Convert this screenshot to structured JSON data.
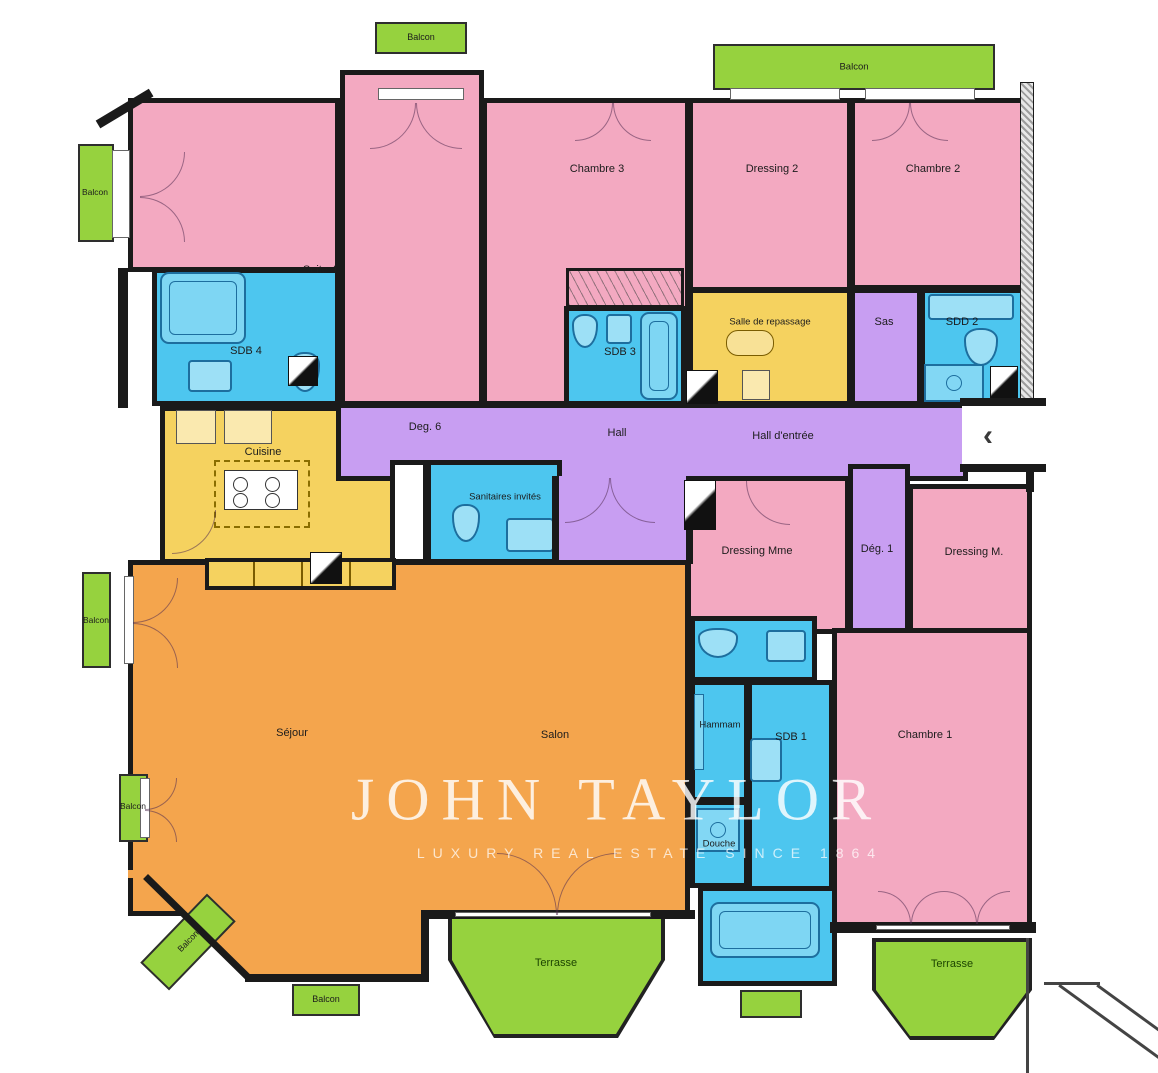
{
  "watermark": {
    "line1": "JOHN TAYLOR",
    "line2": "LUXURY REAL ESTATE SINCE 1864"
  },
  "palette": {
    "pink": "#F3A9C1",
    "blue": "#4DC6EF",
    "yellow": "#F5D25F",
    "purple": "#C89EF2",
    "orange": "#F4A54D",
    "green": "#96D23E",
    "wall": "#1A1A1A"
  },
  "labels": {
    "suite4": "Suite 4",
    "sdb4": "SDB 4",
    "chambre3": "Chambre 3",
    "sdb3": "SDB 3",
    "dressing2": "Dressing 2",
    "salle_de_repassage": "Salle de repassage",
    "sas": "Sas",
    "chambre2": "Chambre 2",
    "sdd2": "SDD 2",
    "deg6": "Deg. 6",
    "hall": "Hall",
    "hall_entree": "Hall d'entrée",
    "cuisine": "Cuisine",
    "sanitaires_invites": "Sanitaires invités",
    "dressing_mme": "Dressing Mme",
    "deg1": "Dég. 1",
    "dressing_m": "Dressing M.",
    "sejour": "Séjour",
    "salon": "Salon",
    "hammam": "Hammam",
    "sdb1": "SDB 1",
    "douche": "Douche",
    "chambre1": "Chambre 1",
    "balcon": "Balcon",
    "terrasse": "Terrasse",
    "entrance_chevron": "‹"
  }
}
